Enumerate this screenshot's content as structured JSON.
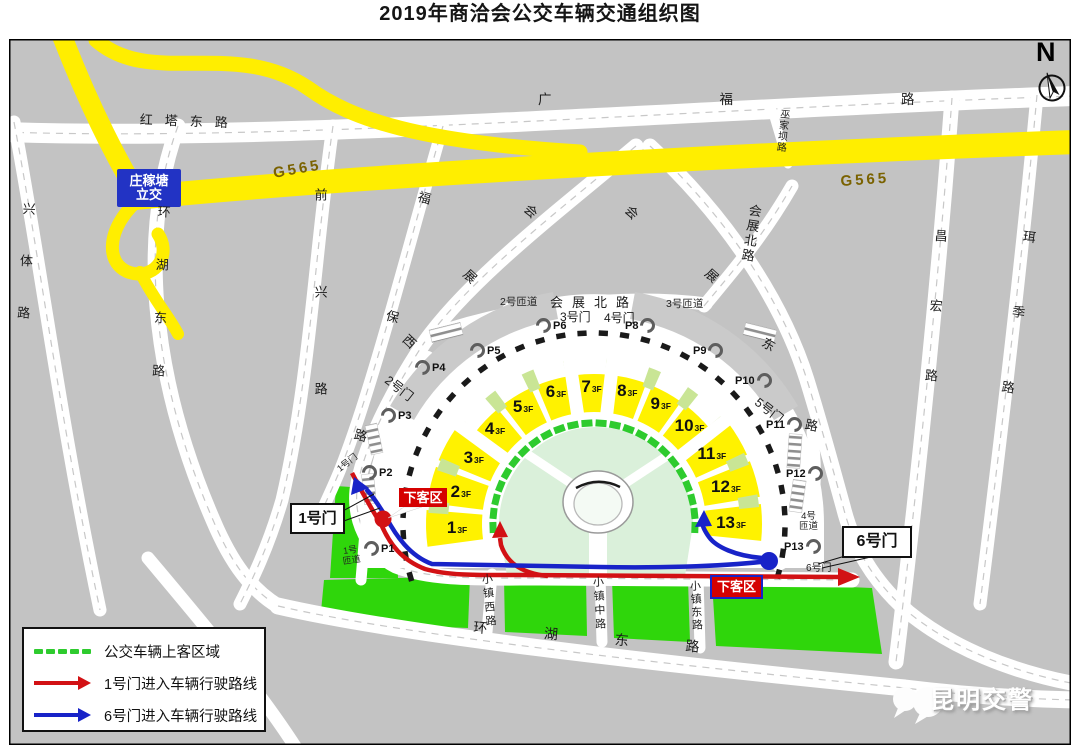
{
  "title": "2019年商洽会公交车辆交通组织图",
  "compass": {
    "letter": "N"
  },
  "highway": {
    "label_left": "G565",
    "label_right": "G565"
  },
  "interchange": {
    "line1": "庄稼塘",
    "line2": "立交"
  },
  "roads": {
    "hongta_dong": "红塔东路",
    "guangfu": "广福路",
    "xingti": "兴体路",
    "huanhu_west": "环湖东路",
    "qianxing": "前兴路",
    "fubao": "福保路",
    "huizhan_xi": "会展西",
    "huizhan_bei_h": "会展北路",
    "huizhan_bei_ne": "会展北路",
    "huizhan_dong": "会展东路",
    "wujiaba": "巫家坝路",
    "changhong": "昌宏路",
    "erji": "珥季路",
    "xiaozhen_xi": "小镇西路",
    "xiaozhen_zhong": "小镇中路",
    "xiaozhen_dong": "小镇东路",
    "huanhu_bottom": "环湖东路"
  },
  "gates": {
    "g1": "1号门",
    "g2": "2号门",
    "g3": "3号门",
    "g4": "4号门",
    "g5": "5号门",
    "g6": "6号门",
    "g1_road": "1号门",
    "g6_road": "6号门"
  },
  "ramps": {
    "r1_line1": "1号",
    "r1_line2": "匝道",
    "r2": "2号匝道",
    "r3": "3号匝道",
    "r4_line1": "4号",
    "r4_line2": "匝道"
  },
  "dropoff": {
    "left": "下客区",
    "right": "下客区"
  },
  "parking": [
    "P1",
    "P2",
    "P3",
    "P4",
    "P5",
    "P6",
    "P8",
    "P9",
    "P10",
    "P11",
    "P12",
    "P13"
  ],
  "halls": [
    {
      "num": "1",
      "floor": "3F"
    },
    {
      "num": "2",
      "floor": "3F"
    },
    {
      "num": "3",
      "floor": "3F"
    },
    {
      "num": "4",
      "floor": "3F"
    },
    {
      "num": "5",
      "floor": "3F"
    },
    {
      "num": "6",
      "floor": "3F"
    },
    {
      "num": "7",
      "floor": "3F"
    },
    {
      "num": "8",
      "floor": "3F"
    },
    {
      "num": "9",
      "floor": "3F"
    },
    {
      "num": "10",
      "floor": "3F"
    },
    {
      "num": "11",
      "floor": "3F"
    },
    {
      "num": "12",
      "floor": "3F"
    },
    {
      "num": "13",
      "floor": "3F"
    }
  ],
  "legend": [
    {
      "type": "boarding-zone",
      "label": "公交车辆上客区域"
    },
    {
      "type": "route-gate1",
      "label": "1号门进入车辆行驶路线"
    },
    {
      "type": "route-gate6",
      "label": "6号门进入车辆行驶路线"
    }
  ],
  "watermark": "昆明交警",
  "colors": {
    "background": "#c3c3c3",
    "road": "#ffffff",
    "highway": "#ffee00",
    "hall_yellow": "#fff200",
    "mini_green": "#c9e595",
    "lawn_green": "#2fd60b",
    "inner_green": "#daf0da",
    "route_red": "#d21114",
    "route_blue": "#1823c8",
    "dropoff_red": "#d50000",
    "interchange_blue": "#2233c4",
    "boarding_dash_green": "#2ecb2e",
    "highway_text": "#7a6200"
  }
}
